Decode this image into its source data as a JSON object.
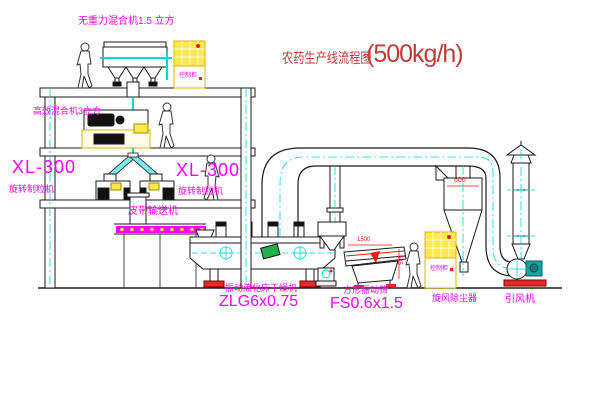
{
  "title": {
    "text": "农药生产线流程图",
    "capacity": "(500kg/h)"
  },
  "equipment": {
    "gravity_mixer": {
      "label": "无重力混合机1.5 立方"
    },
    "high_efficiency_mixer": {
      "label": "高效混合机3立方"
    },
    "granulator_left": {
      "model": "XL-300",
      "name": "旋转制粒机"
    },
    "granulator_center": {
      "model": "XL-300",
      "name": "旋转制粒机"
    },
    "belt_conveyor": {
      "label": "皮带输送机"
    },
    "fluid_bed_dryer": {
      "name": "振动流化床干燥机",
      "model": "ZLG6x0.75"
    },
    "vibrating_screen": {
      "name": "方形振动筛",
      "model": "FS0.6x1.5"
    },
    "cyclone_dust_collector": {
      "label": "旋风除尘器"
    },
    "induced_draft_fan": {
      "label": "引风机"
    },
    "control_cabinet_1": {
      "label": "控制柜"
    },
    "control_cabinet_2": {
      "label": "控制柜"
    }
  },
  "dimensions": {
    "cyclone_diameter": "600",
    "screen_length": "1500",
    "screen_height": "545"
  },
  "colors": {
    "label_magenta": "#ff00ff",
    "title_red": "#c23b3b",
    "dimension_red": "#ff1515",
    "pipe_centerline_cyan": "#00d8d8",
    "cabinet_yellow": "#ffe94d",
    "drawing_line_black": "#1a1a1a",
    "belt_magenta": "#ff00ff",
    "motor_green": "#22b14c"
  }
}
